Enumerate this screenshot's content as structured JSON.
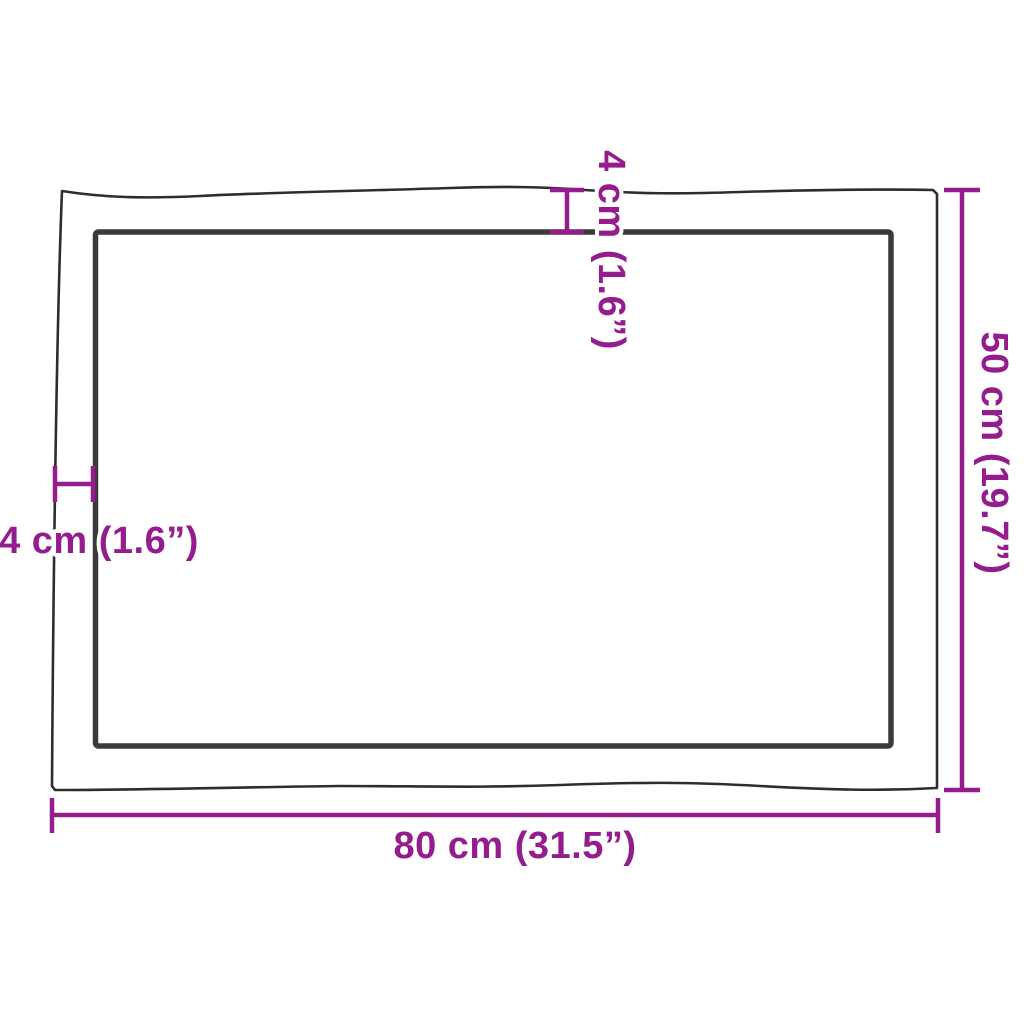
{
  "diagram": {
    "type": "product-dimension-diagram",
    "labels": {
      "width": "80 cm (31.5”)",
      "height": "50 cm (19.7”)",
      "edge_top": "4 cm (1.6”)",
      "edge_left": "4 cm (1.6”)"
    },
    "colors": {
      "dimension": "#941C8C",
      "board_outline": "#2D2D2D",
      "inner_edge": "#3A3A3A",
      "background": "#FFFFFF"
    }
  }
}
